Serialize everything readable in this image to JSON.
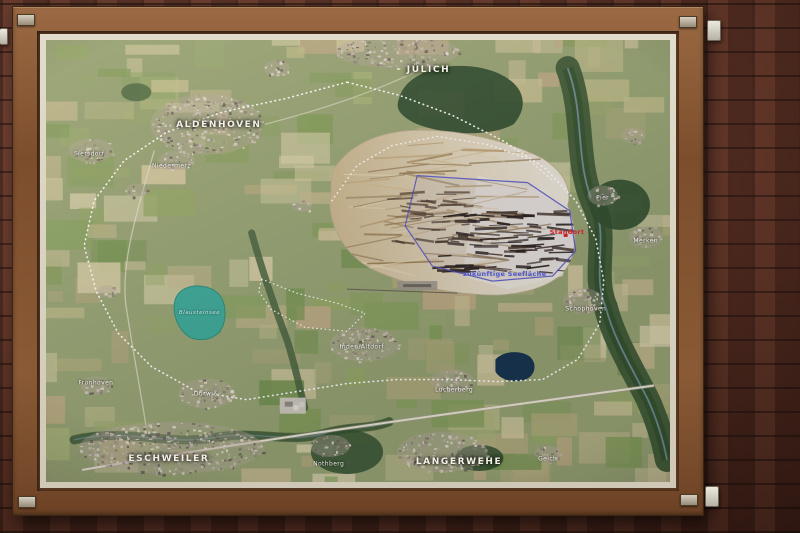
{
  "scene": {
    "type": "photograph",
    "subject": "Framed aerial satellite map of the Inden open-cast mine region, mounted on a red brick wall",
    "frame_color": "#8a5a36",
    "mat_color": "#ddd6c6",
    "wall_color": "#6a3326"
  },
  "map": {
    "city_labels": [
      {
        "text": "JÜLICH",
        "x": 61.3,
        "y": 6.8
      },
      {
        "text": "ALDENHOVEN",
        "x": 27.7,
        "y": 19.3
      },
      {
        "text": "ESCHWEILER",
        "x": 19.7,
        "y": 94.8
      },
      {
        "text": "LANGERWEHE",
        "x": 66.2,
        "y": 95.5
      }
    ],
    "village_labels": [
      {
        "text": "Siersdorf",
        "x": 6.9,
        "y": 25.9
      },
      {
        "text": "Niedermerz",
        "x": 20.1,
        "y": 28.4
      },
      {
        "text": "Fronhoven",
        "x": 8.0,
        "y": 77.7
      },
      {
        "text": "Dürwiß",
        "x": 25.6,
        "y": 80.0
      },
      {
        "text": "Inden/Altdorf",
        "x": 50.6,
        "y": 69.5
      },
      {
        "text": "Lucherberg",
        "x": 65.4,
        "y": 79.1
      },
      {
        "text": "Schophoven",
        "x": 86.5,
        "y": 60.9
      },
      {
        "text": "Pier",
        "x": 89.2,
        "y": 35.7
      },
      {
        "text": "Merken",
        "x": 96.1,
        "y": 45.5
      },
      {
        "text": "Nothberg",
        "x": 45.3,
        "y": 95.9
      },
      {
        "text": "Geich",
        "x": 80.4,
        "y": 94.8
      }
    ],
    "water_labels": [
      {
        "text": "Blausteinsee",
        "x": 24.6,
        "y": 61.8
      }
    ],
    "annotations": [
      {
        "text": "Standort",
        "x": 83.5,
        "y": 43.5,
        "color": "#d42020"
      },
      {
        "text": "zukünftige Seefläche",
        "x": 73.5,
        "y": 53.0,
        "color": "#5055c8"
      }
    ],
    "feature_colors": {
      "future_lake_outline": "#4d4dc4",
      "route_dotted": "#ffffff",
      "blausteinsee": "#3aa796",
      "lucherberger_see": "#17344e",
      "open_pit": "#ddd2ba"
    }
  }
}
